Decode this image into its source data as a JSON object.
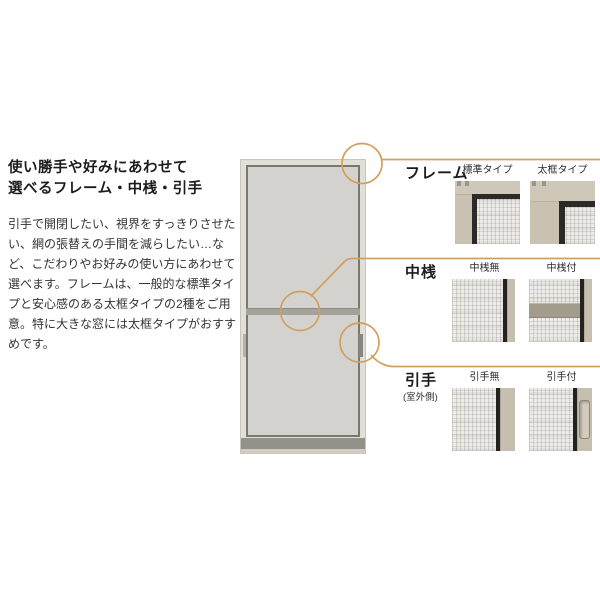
{
  "accent_color": "#d1a05f",
  "intro": {
    "heading_line1": "使い勝手や好みにあわせて",
    "heading_line2": "選べるフレーム・中桟・引手",
    "body": "引手で開閉したい、視界をすっきりさせたい、網の張替えの手間を減らしたい…など、こだわりやお好みの使い方にあわせて選べます。フレームは、一般的な標準タイプと安心感のある太框タイプの2種をご用意。特に大きな窓には太框タイプがおすすめです。"
  },
  "sections": [
    {
      "label": "フレーム",
      "options": [
        {
          "caption": "標準タイプ"
        },
        {
          "caption": "太框タイプ"
        }
      ]
    },
    {
      "label": "中桟",
      "options": [
        {
          "caption": "中桟無"
        },
        {
          "caption": "中桟付"
        }
      ]
    },
    {
      "label": "引手",
      "sublabel": "(室外側)",
      "options": [
        {
          "caption": "引手無"
        },
        {
          "caption": "引手付"
        }
      ]
    }
  ]
}
